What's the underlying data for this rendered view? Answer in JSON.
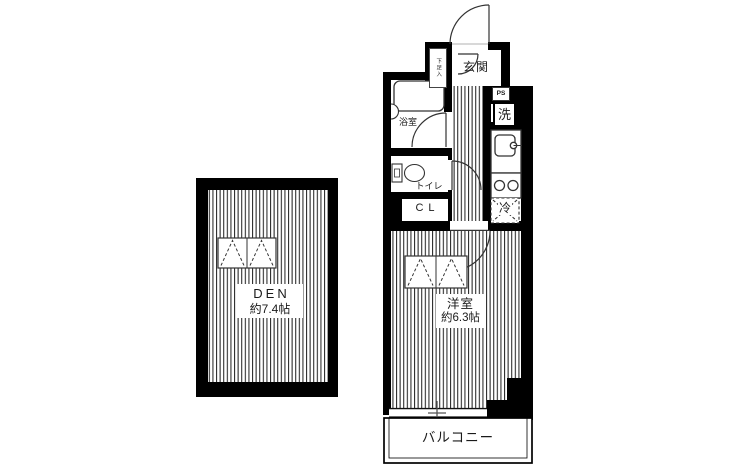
{
  "floorplan": {
    "rooms": {
      "den": {
        "label": "DEN",
        "area": "約7.4帖"
      },
      "western_room": {
        "label": "洋室",
        "area": "約6.3帖"
      },
      "entrance": {
        "label": "玄関"
      },
      "shoe_cupboard": {
        "label": "下足入"
      },
      "bathroom": {
        "label": "浴室"
      },
      "toilet": {
        "label": "トイレ"
      },
      "closet": {
        "label": "CL"
      },
      "washing_machine": {
        "label": "洗"
      },
      "refrigerator": {
        "label": "冷"
      },
      "pipe_space": {
        "label": "PS"
      },
      "balcony": {
        "label": "バルコニー"
      }
    },
    "colors": {
      "wall": "#000000",
      "floor": "#ffffff",
      "hatch_line": "#262626",
      "fixture_line": "#333333"
    }
  }
}
